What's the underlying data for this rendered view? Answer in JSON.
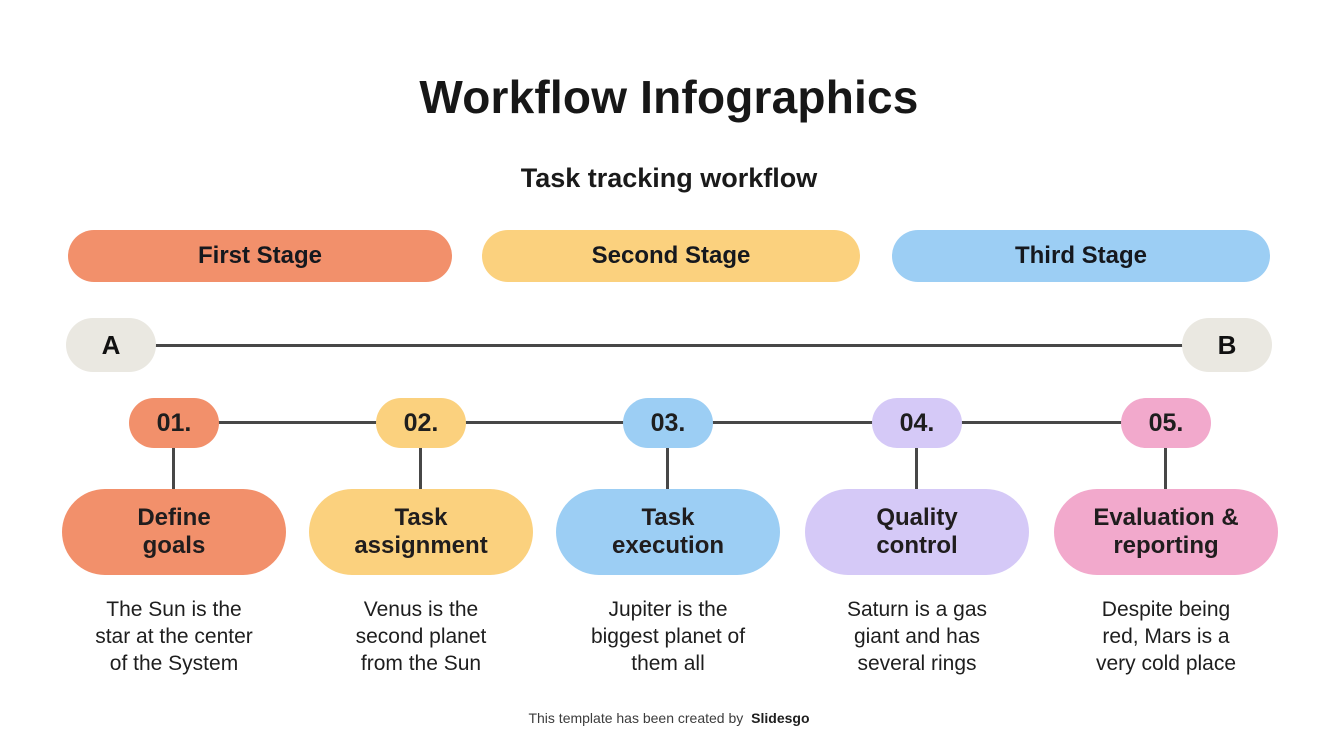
{
  "slide": {
    "title": "Workflow Infographics",
    "subtitle": "Task tracking workflow",
    "footer": {
      "text": "This template has been created by",
      "brand": "Slidesgo"
    }
  },
  "stages": [
    {
      "label": "First Stage",
      "color": "#F2906B"
    },
    {
      "label": "Second Stage",
      "color": "#FBD17E"
    },
    {
      "label": "Third Stage",
      "color": "#9CCEF4"
    }
  ],
  "timeline": {
    "start_label": "A",
    "end_label": "B",
    "track_color": "#EAE8E1",
    "line_color": "#474747"
  },
  "steps": [
    {
      "number": "01.",
      "label": "Define\ngoals",
      "description": "The Sun is the\nstar at the center\nof the System",
      "color": "#F2906B"
    },
    {
      "number": "02.",
      "label": "Task\nassignment",
      "description": "Venus is the\nsecond planet\nfrom the Sun",
      "color": "#FBD17E"
    },
    {
      "number": "03.",
      "label": "Task\nexecution",
      "description": "Jupiter is the\nbiggest planet of\nthem all",
      "color": "#9CCEF4"
    },
    {
      "number": "04.",
      "label": "Quality\ncontrol",
      "description": "Saturn is a gas\ngiant and has\nseveral rings",
      "color": "#D5C9F7"
    },
    {
      "number": "05.",
      "label": "Evaluation &\nreporting",
      "description": "Despite being\nred, Mars is a\nvery cold place",
      "color": "#F2A9CC"
    }
  ]
}
